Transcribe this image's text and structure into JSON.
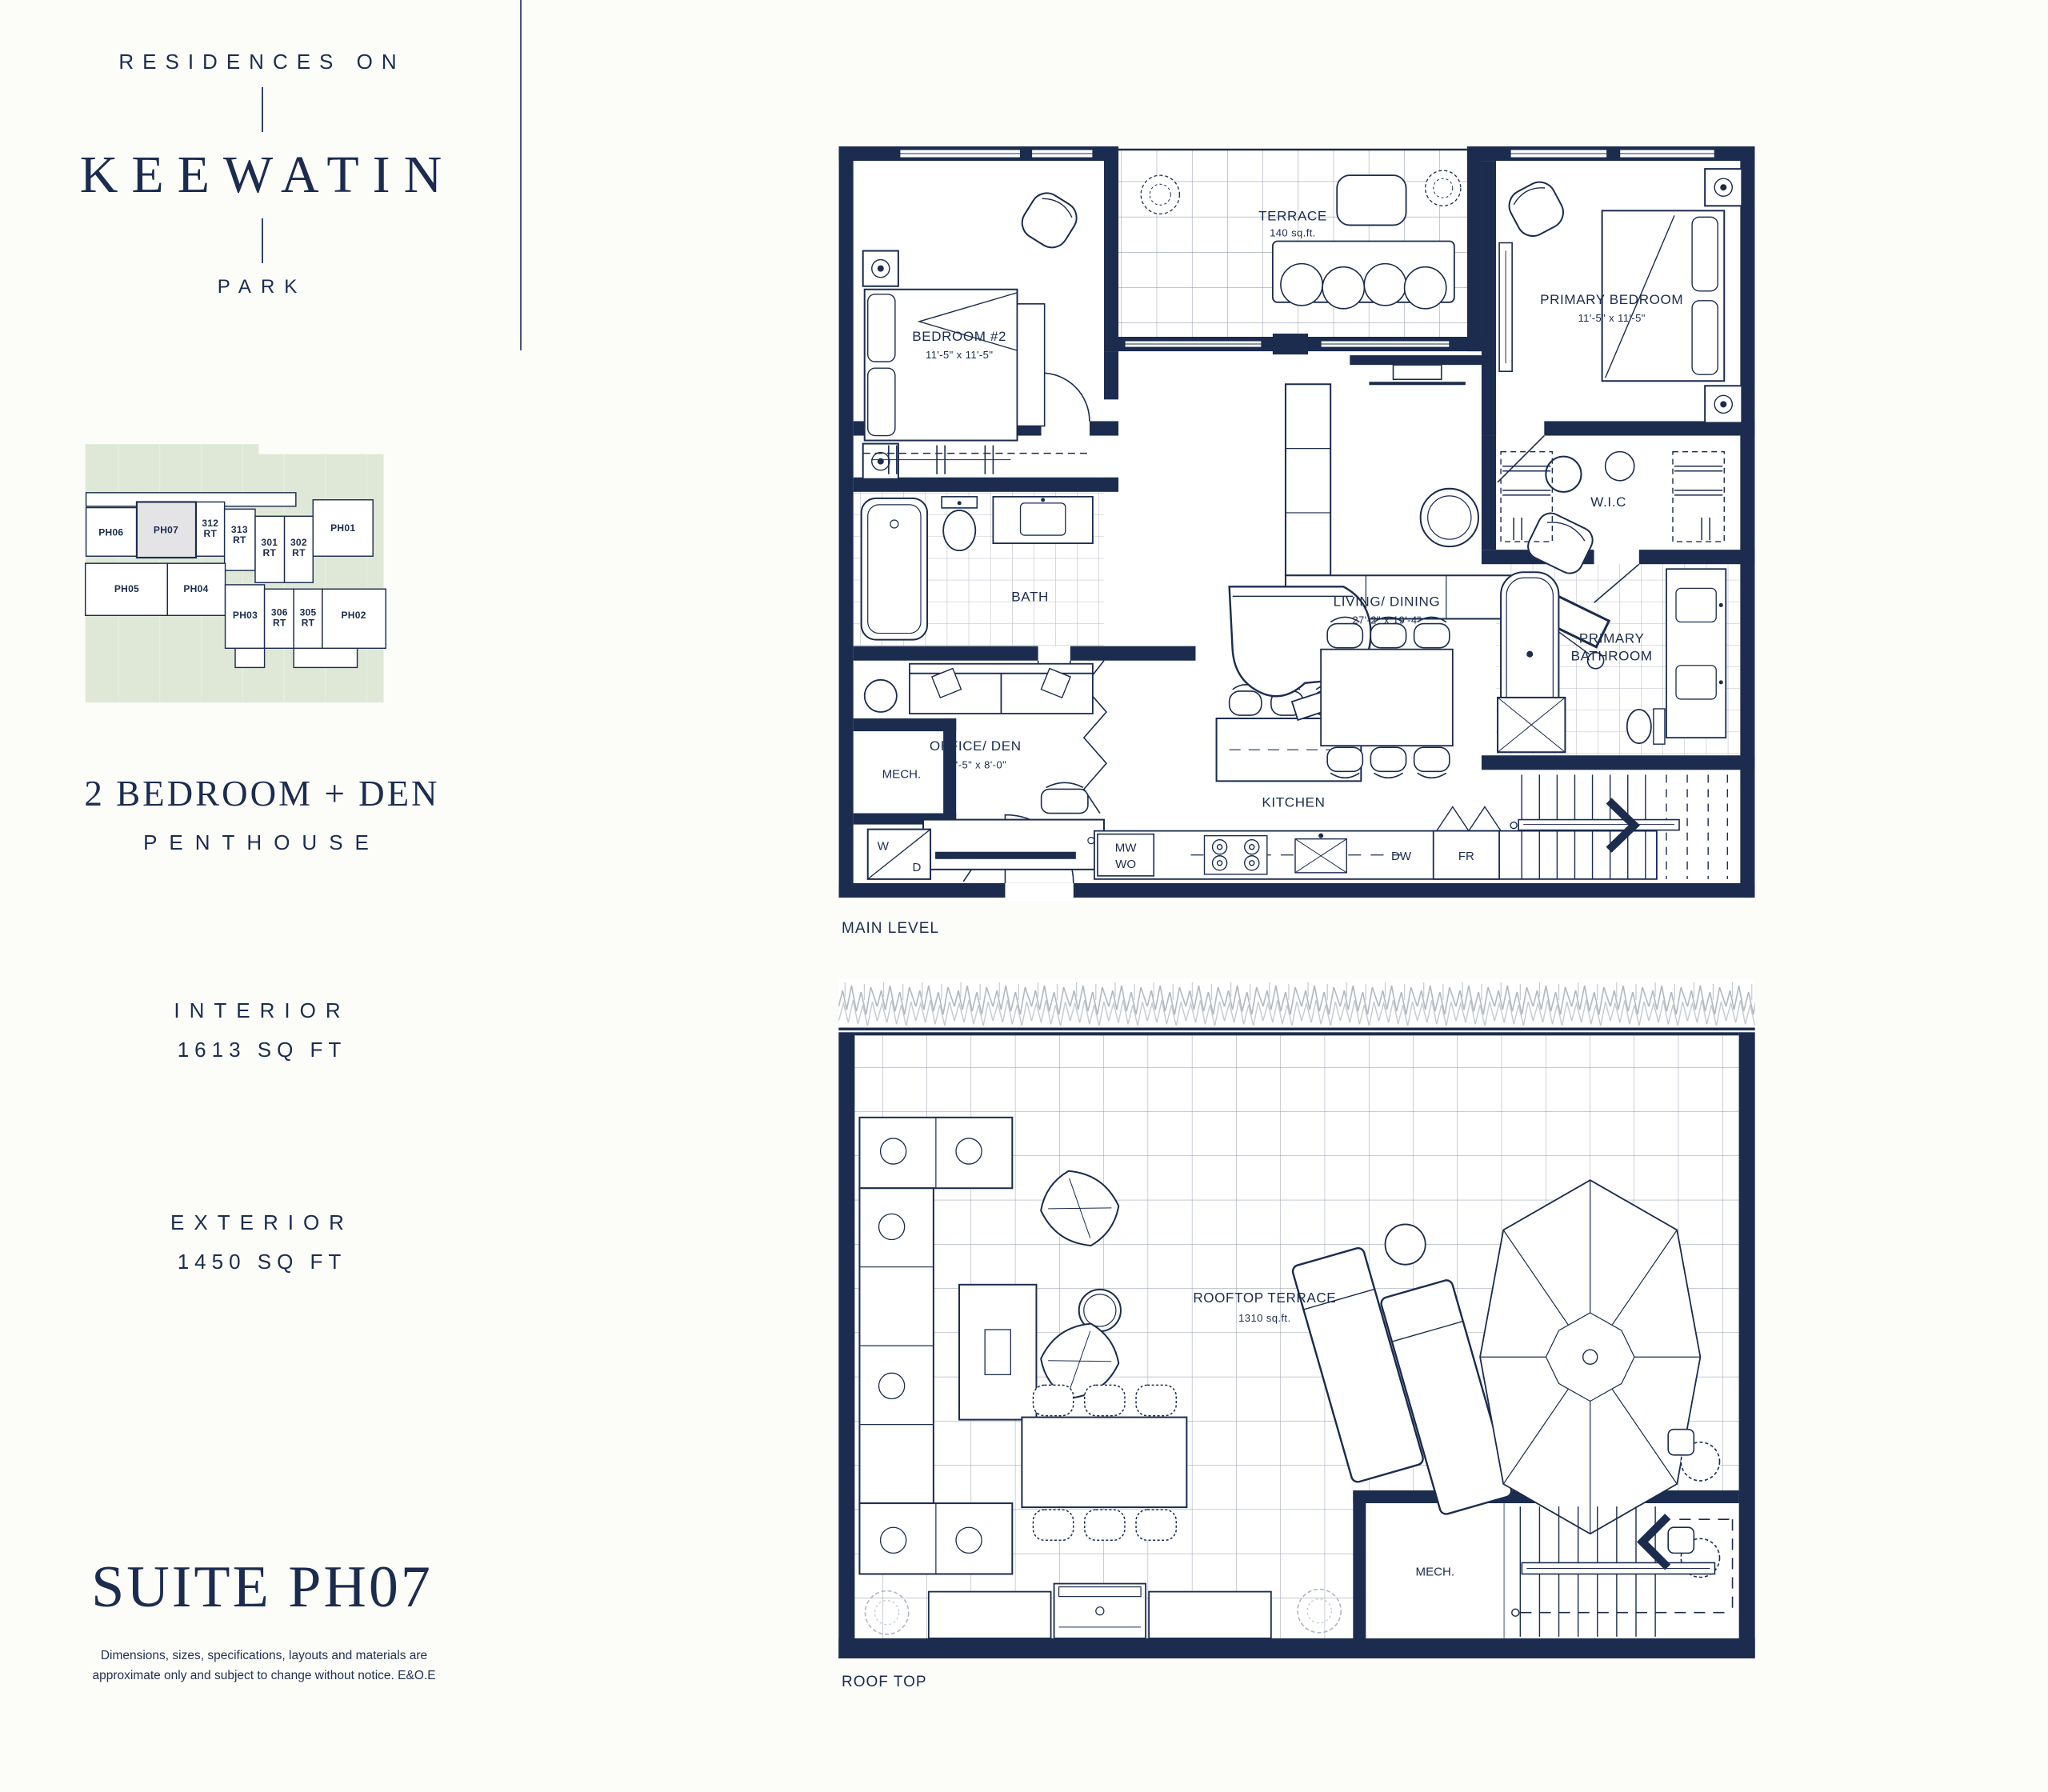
{
  "colors": {
    "navy": "#1b2c4f",
    "keyplan_green": "#dfe8d7",
    "highlight_gray": "#e4e4e6",
    "paper": "#fcfcf9"
  },
  "sidebar": {
    "brand": {
      "top": "RESIDENCES ON",
      "name": "KEEWATIN",
      "bottom": "PARK"
    },
    "keyplan": {
      "units": [
        {
          "num": "PH06"
        },
        {
          "num": "PH07",
          "highlighted": true
        },
        {
          "num": "312",
          "suffix": "RT"
        },
        {
          "num": "313",
          "suffix": "RT"
        },
        {
          "num": "301",
          "suffix": "RT"
        },
        {
          "num": "302",
          "suffix": "RT"
        },
        {
          "num": "PH01"
        },
        {
          "num": "PH05"
        },
        {
          "num": "PH04"
        },
        {
          "num": "PH03"
        },
        {
          "num": "306",
          "suffix": "RT"
        },
        {
          "num": "305",
          "suffix": "RT"
        },
        {
          "num": "PH02"
        }
      ]
    },
    "suite_type": "2 BEDROOM + DEN",
    "suite_class": "PENTHOUSE",
    "interior": {
      "label": "INTERIOR",
      "value": "1613 SQ FT"
    },
    "exterior": {
      "label": "EXTERIOR",
      "value": "1450 SQ FT"
    },
    "suite_title": "SUITE PH07",
    "disclaimer": "Dimensions, sizes, specifications, layouts and materials are approximate only and subject to change without notice. E&O.E"
  },
  "main_level": {
    "caption": "MAIN LEVEL",
    "terrace": {
      "name": "TERRACE",
      "area": "140 sq.ft."
    },
    "bedroom2": {
      "name": "BEDROOM #2",
      "dims": "11'-5\" x 11'-5\""
    },
    "primary_bedroom": {
      "name": "PRIMARY BEDROOM",
      "dims": "11'-5\" x 11'-5\""
    },
    "bath": "BATH",
    "wic": "W.I.C",
    "office": {
      "name": "OFFICE/ DEN",
      "dims": "11'-5\" x 8'-0\""
    },
    "living": {
      "name": "LIVING/ DINING",
      "dims": "27'-2\" x 19'-4\""
    },
    "primary_bath_line1": "PRIMARY",
    "primary_bath_line2": "BATHROOM",
    "mech": "MECH.",
    "kitchen": "KITCHEN",
    "appliances": {
      "washer": "W",
      "dryer": "D",
      "mw": "MW",
      "wo": "WO",
      "dw": "DW",
      "fr": "FR"
    }
  },
  "roof": {
    "caption": "ROOF TOP",
    "terrace": {
      "name": "ROOFTOP TERRACE",
      "area": "1310 sq.ft."
    },
    "mech": "MECH."
  }
}
